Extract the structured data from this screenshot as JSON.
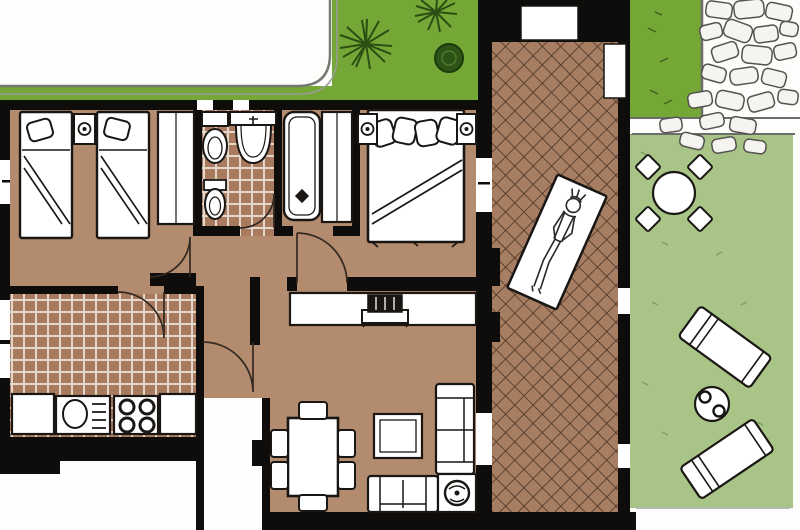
{
  "palette": {
    "page": "#fdfdfb",
    "garden_green": "#74a735",
    "lawn_green": "#a8c487",
    "floor_tan": "#b38b6e",
    "terrace_tile": "#a87e63",
    "terrace_line": "#432f21",
    "bath_tile": "#a97a5e",
    "grout": "#e3d8cb",
    "wall": "#0f0d0b",
    "outline": "#191613",
    "fixture_white": "#ffffff",
    "stone_fill": "#f5f4f0",
    "stone_line": "#55534f",
    "plant_dark": "#2c4e14",
    "arc_line": "#33291f",
    "lawn_tick": "#7fa05e",
    "edge_gray": "#6d6d6b"
  },
  "scene": {
    "garden_top": {
      "items": [
        "starburst-plant",
        "starburst-plant",
        "round-bush"
      ]
    },
    "rock_path": {
      "items": [
        "stone-cluster",
        "path-border-lines"
      ]
    },
    "terrace": {
      "items": [
        "diamond-tile-floor",
        "window-opening",
        "garden-gate",
        "sunbathing-person",
        "beach-towel"
      ]
    },
    "lawn": {
      "items": [
        "round-garden-table",
        "garden-chair",
        "garden-chair",
        "garden-chair",
        "garden-chair",
        "sun-lounger",
        "sun-lounger",
        "drinks-table-with-two-cups"
      ]
    },
    "twin_bedroom": {
      "items": [
        "single-bed",
        "single-bed",
        "nightstand-with-lamp",
        "wardrobe",
        "window",
        "door-arc"
      ]
    },
    "bathroom": {
      "items": [
        "toilet",
        "bidet",
        "washbasin",
        "tiled-floor",
        "door-arc",
        "window",
        "window"
      ]
    },
    "bath_nook": {
      "items": [
        "bathtub",
        "closet"
      ]
    },
    "master_bedroom": {
      "items": [
        "double-bed",
        "pillow",
        "pillow",
        "pillow",
        "pillow",
        "nightstand-with-lamp",
        "nightstand-with-lamp",
        "terrace-window",
        "door-arc"
      ]
    },
    "kitchen": {
      "items": [
        "tiled-floor",
        "counter-cabinet",
        "sink-unit",
        "stove-four-burners",
        "counter-cabinet",
        "window",
        "window",
        "door-arc"
      ]
    },
    "living_dining": {
      "items": [
        "sideboard",
        "tv-set",
        "dining-table",
        "dining-chair",
        "dining-chair",
        "dining-chair",
        "dining-chair",
        "dining-chair",
        "dining-chair",
        "coffee-table",
        "sofa",
        "sofa",
        "corner-plant-stand",
        "terrace-door"
      ]
    },
    "entry": {
      "items": [
        "entry-corridor",
        "door-arc"
      ]
    }
  }
}
